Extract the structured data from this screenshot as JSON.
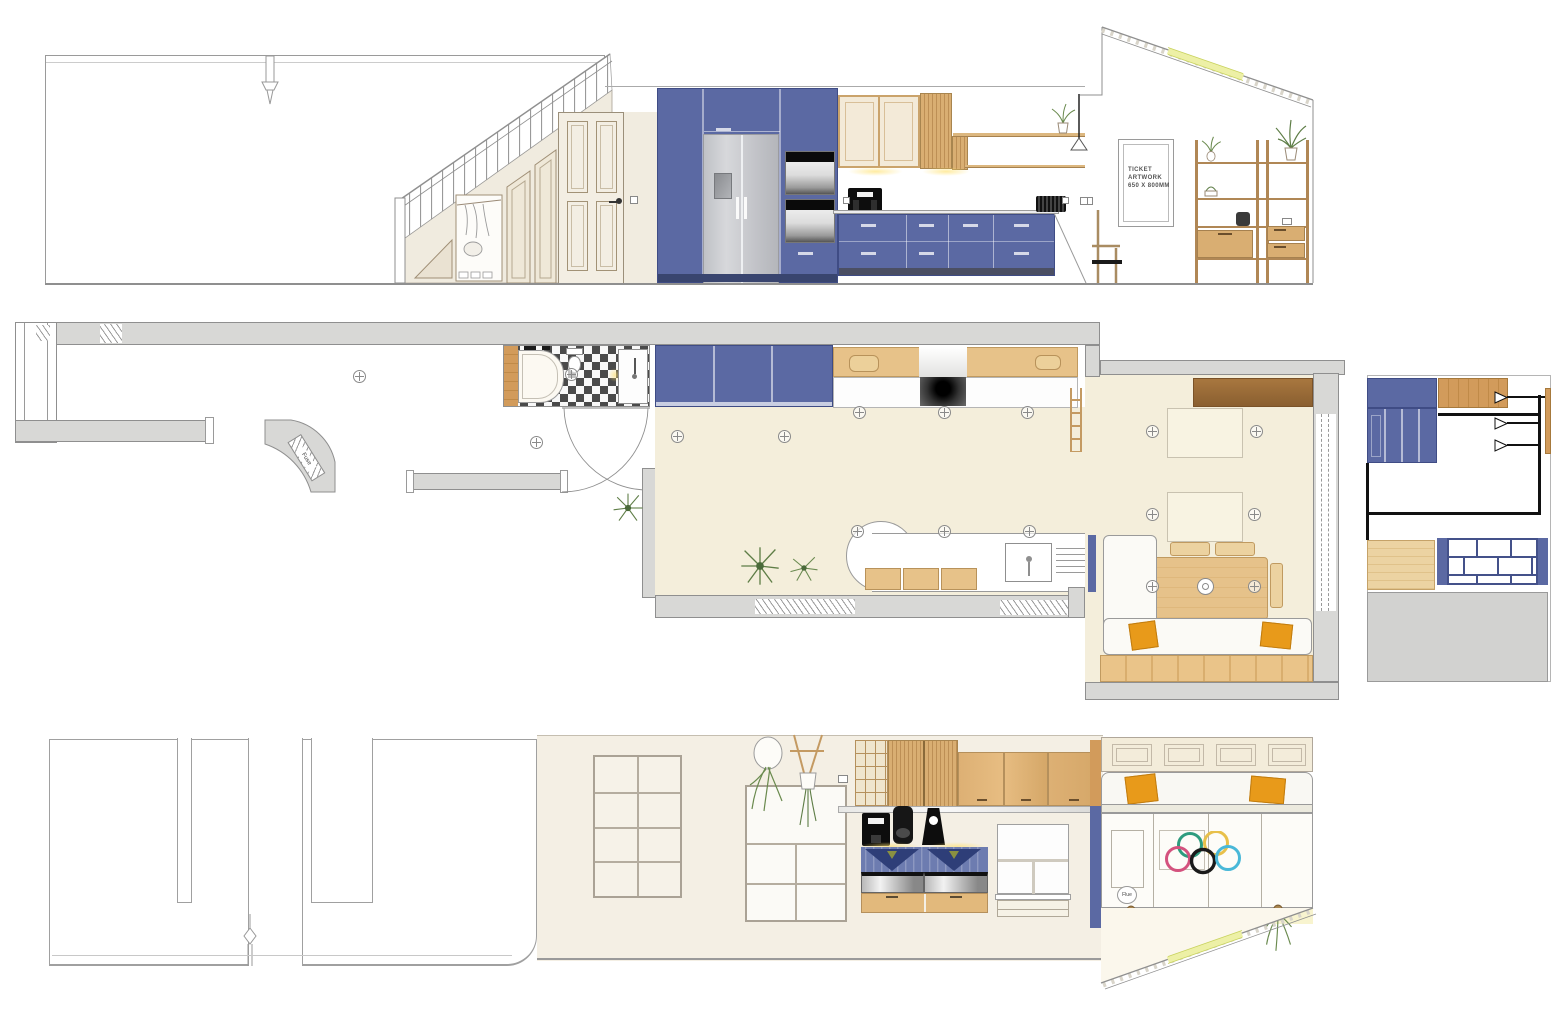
{
  "labels": {
    "ticket_line1": "TICKET",
    "ticket_line2": "ARTWORK",
    "ticket_line3": "650 X 800MM",
    "fuse": "Fuse",
    "flue": "Flue"
  },
  "colors": {
    "cabinet_blue": "#5b69a3",
    "cabinet_blue_dark": "#3f4c85",
    "plinth_dark": "#4b4f63",
    "wood_light": "#e0b67e",
    "wood_mid": "#d29b5b",
    "wood_dark": "#9c6b3c",
    "wall_cream": "#f1ece0",
    "floor_beige": "#f4eedb",
    "plan_wall_gray": "#d8d8d6",
    "cushion_orange": "#e89a1a",
    "skylight_yellow": "#edf0a6",
    "fridge_gray": "#c9cacd",
    "ring_green": "#2e9c7e",
    "ring_yellow": "#e8c04a",
    "ring_pink": "#d4527e",
    "ring_black": "#1a1a1a",
    "ring_cyan": "#49b8d8"
  }
}
